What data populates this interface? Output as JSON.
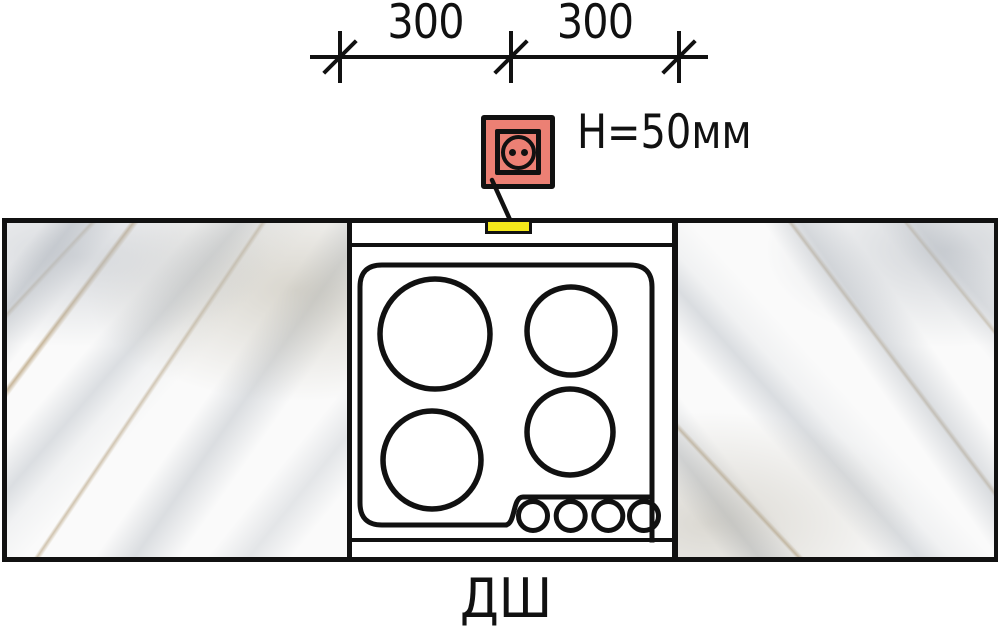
{
  "dimension": {
    "segments": [
      {
        "label": "300"
      },
      {
        "label": "300"
      }
    ]
  },
  "socket": {
    "label": "H=50мм",
    "icon": "power-outlet-icon"
  },
  "hob": {
    "burner_count": 4,
    "knob_count": 4
  },
  "footer": {
    "label": "ДШ"
  },
  "colors": {
    "line": "#111111",
    "socket_fill": "#EC8074",
    "marker_fill": "#F3E81A"
  }
}
